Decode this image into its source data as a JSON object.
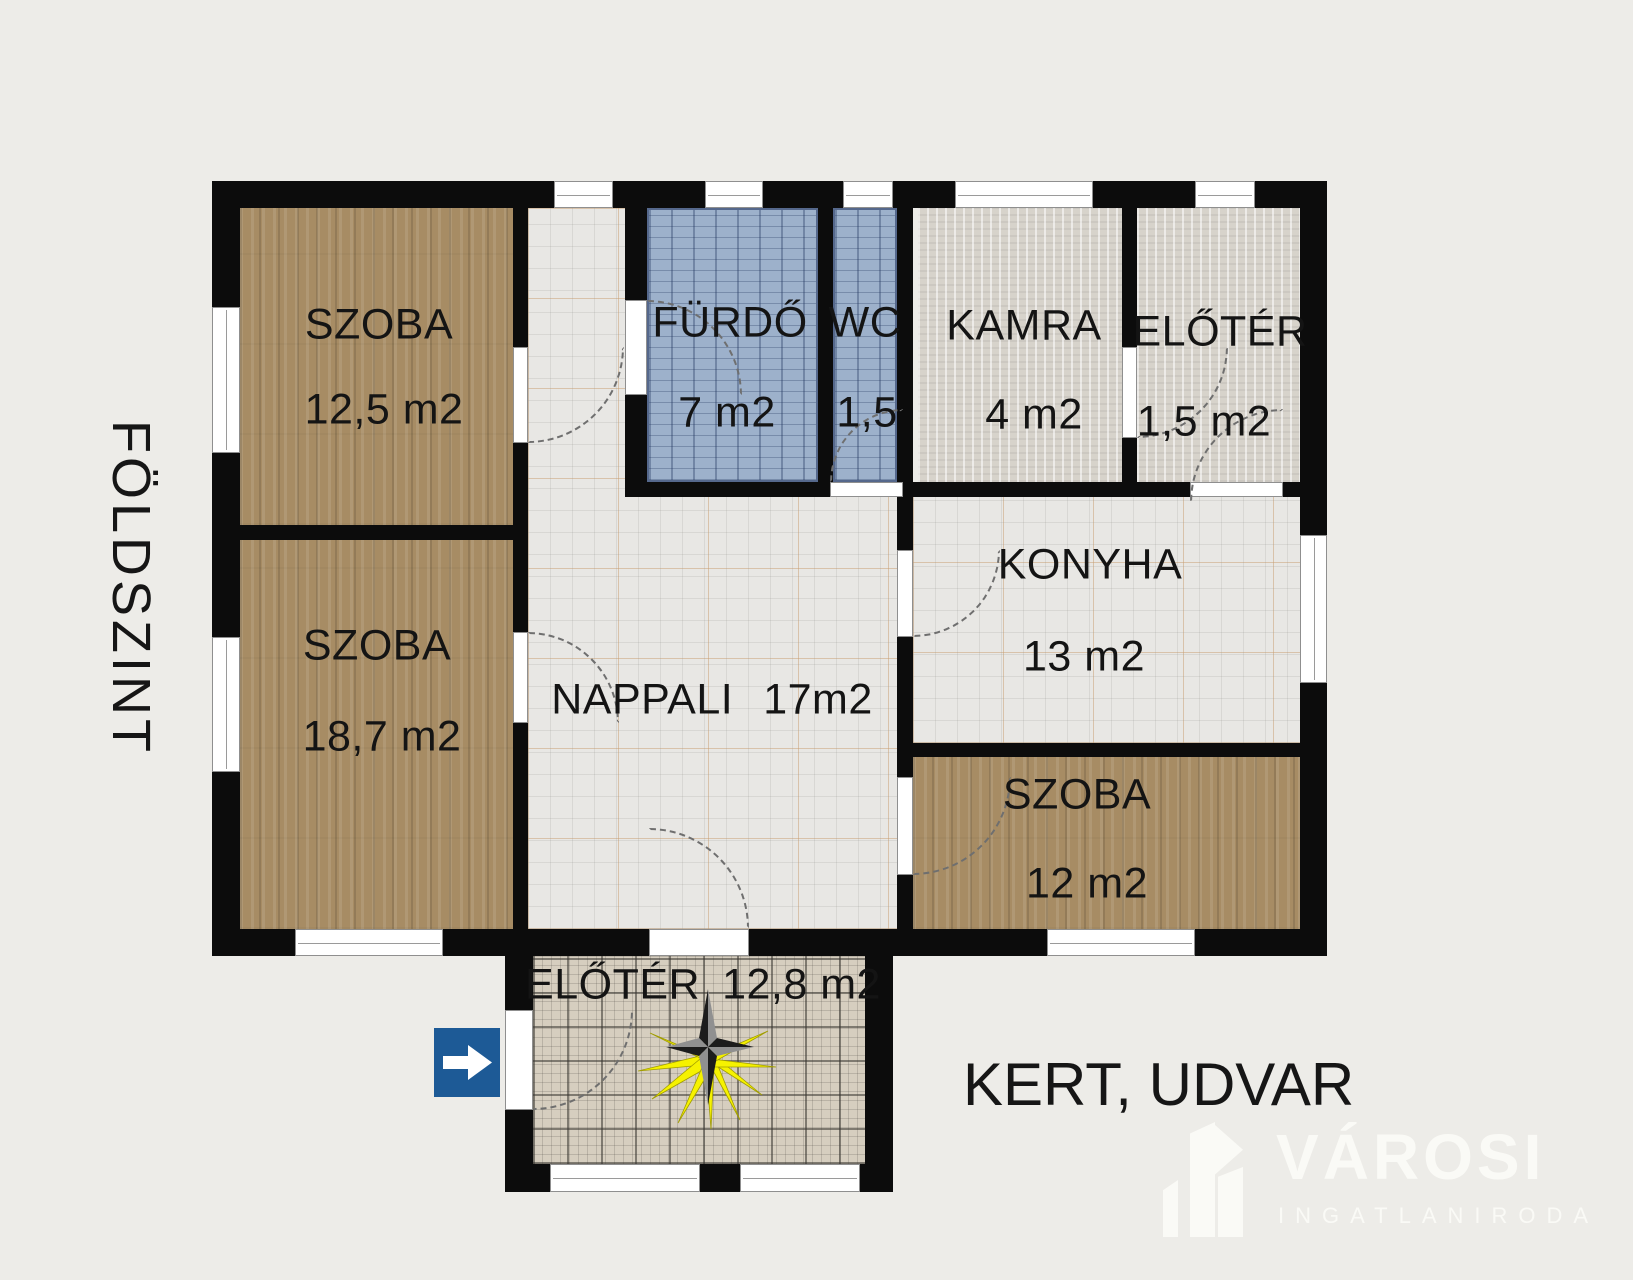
{
  "floor_title": "FÖLDSZINT",
  "outside_label": "KERT, UDVAR",
  "rooms": {
    "szoba_felso": {
      "name": "SZOBA",
      "area": "12,5 m2"
    },
    "szoba_also": {
      "name": "SZOBA",
      "area": "18,7 m2"
    },
    "furdo": {
      "name": "FÜRDŐ",
      "area": "7 m2"
    },
    "wc": {
      "name": "WC",
      "area": "1,5"
    },
    "kamra": {
      "name": "KAMRA",
      "area": "4 m2"
    },
    "eloter_felso": {
      "name": "ELŐTÉR",
      "area": "1,5 m2"
    },
    "konyha": {
      "name": "KONYHA",
      "area": "13 m2"
    },
    "nappali": {
      "name": "NAPPALI",
      "area": "17m2"
    },
    "szoba_jobb": {
      "name": "SZOBA",
      "area": "12 m2"
    },
    "eloter_also": {
      "name": "ELŐTÉR",
      "area": "12,8 m2"
    }
  },
  "watermark": {
    "brand": "VÁROSI",
    "subtitle": "INGATLANIRODA"
  },
  "icons": {
    "entrance_arrow": "right-arrow",
    "compass": "compass-star-with-sun-rays"
  },
  "colors": {
    "background": "#edece8",
    "wall": "#0c0c0c",
    "wood_floor": "#a78c64",
    "bath_tile": "#9db1cb",
    "pantry_floor": "#d7d3cb",
    "living_tile": "#e8e7e4",
    "hall_tile": "#d6cebf",
    "entrance_sign_blue": "#1d5a96",
    "compass_ray_yellow": "#f6f200"
  }
}
